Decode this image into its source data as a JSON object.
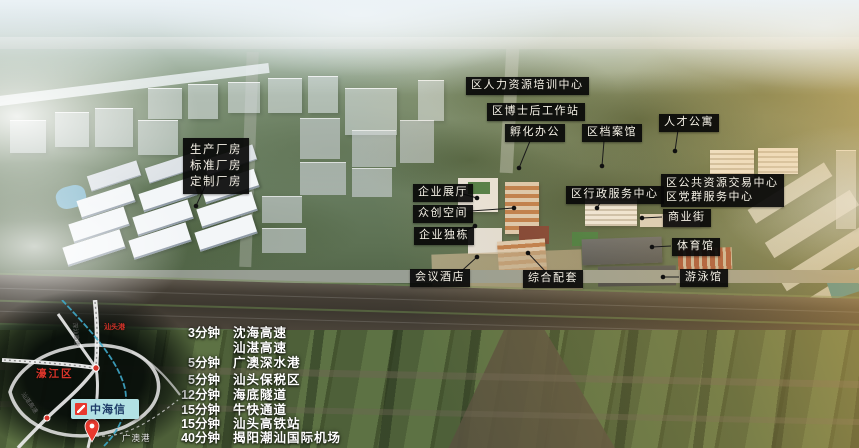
{
  "callouts": {
    "factory_lines": [
      "生产厂房",
      "标准厂房",
      "定制厂房"
    ],
    "hr_training_center": "区人力资源培训中心",
    "postdoc_workstation": "区博士后工作站",
    "incubation_office": "孵化办公",
    "district_archives": "区档案馆",
    "talent_apartment": "人才公寓",
    "enterprise_hall": "企业展厅",
    "cocreate_space": "众创空间",
    "enterprise_building": "企业独栋",
    "conference_hotel": "会议酒店",
    "complex_support": "综合配套",
    "admin_service_center": "区行政服务中心",
    "public_resource_center": "区公共资源交易中心",
    "party_mass_center": "区党群服务中心",
    "commercial_street": "商业街",
    "gymnasium": "体育馆",
    "natatorium": "游泳馆"
  },
  "travel_times": [
    {
      "time": "3分钟",
      "place": "沈海高速"
    },
    {
      "time": "",
      "place": "汕湛高速"
    },
    {
      "time": "5分钟",
      "place": "广澳深水港"
    },
    {
      "time": "5分钟",
      "place": "汕头保税区"
    },
    {
      "time": "12分钟",
      "place": "海底隧道"
    },
    {
      "time": "15分钟",
      "place": "牛快通道"
    },
    {
      "time": "15分钟",
      "place": "汕头高铁站"
    },
    {
      "time": "40分钟",
      "place": "揭阳潮汕国际机场"
    }
  ],
  "map_inset": {
    "district_label": "濠江区",
    "brand_label": "中海信",
    "port_label": "广澳港",
    "north_port_label": "汕头港",
    "road_label_left": "汕湛高速",
    "road_label_center": "深汕高速"
  },
  "colors": {
    "callout_bg": "#0a0a0a",
    "callout_text": "#f5f1e6",
    "brand_box_bg": "#b2e1e4",
    "brand_text_blue": "#1c3a66",
    "brand_logo_red": "#e8392e",
    "map_red": "#d8342a",
    "rail_cyan": "#3fa9c9"
  }
}
